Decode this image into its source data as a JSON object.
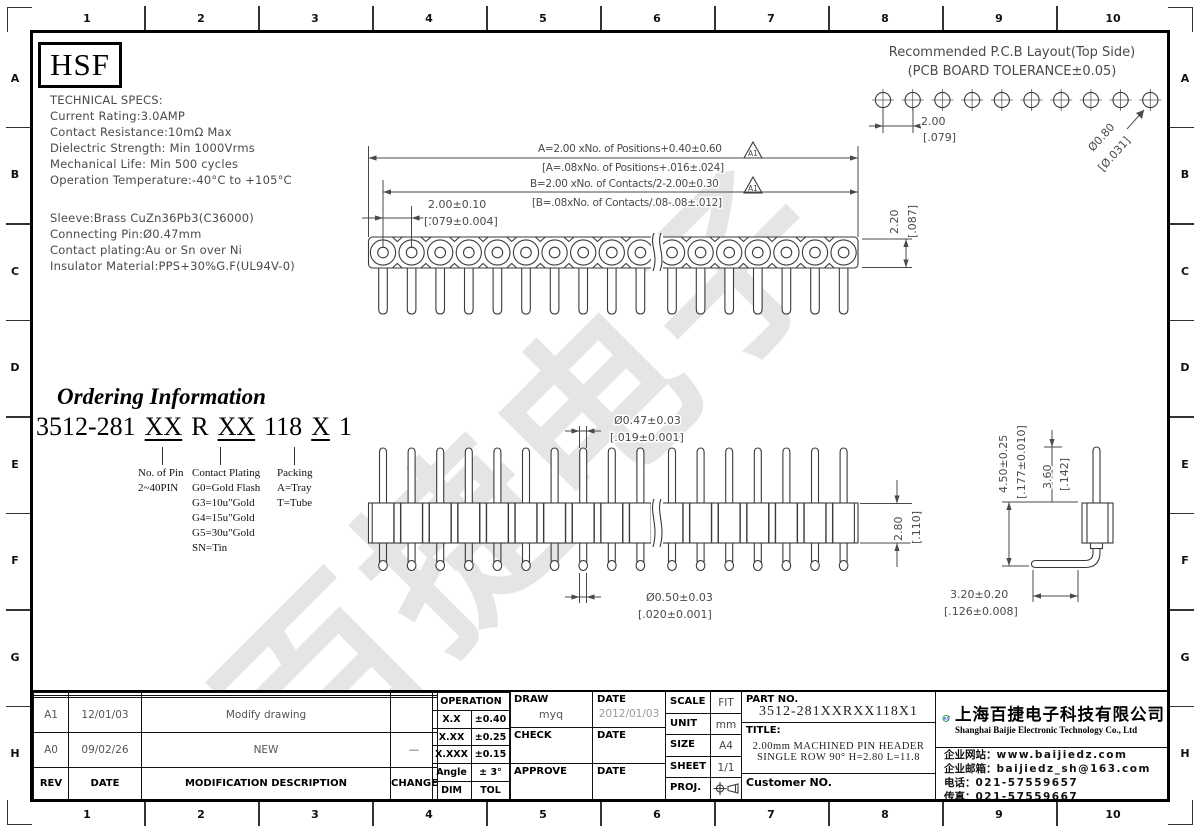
{
  "frame": {
    "columns": [
      "1",
      "2",
      "3",
      "4",
      "5",
      "6",
      "7",
      "8",
      "9",
      "10"
    ],
    "rows": [
      "A",
      "B",
      "C",
      "D",
      "E",
      "F",
      "G",
      "H"
    ]
  },
  "header_logo": "HSF",
  "watermark": "百捷电子",
  "tech_specs": {
    "lines1": [
      "TECHNICAL SPECS:",
      "Current Rating:3.0AMP",
      "Contact Resistance:10mΩ Max",
      "Dielectric Strength: Min 1000Vrms",
      "Mechanical Life: Min 500 cycles",
      "Operation Temperature:-40°C to +105°C"
    ],
    "lines2": [
      "Sleeve:Brass CuZn36Pb3(C36000)",
      "Connecting Pin:Ø0.47mm",
      "Contact plating:Au or Sn over Ni",
      "Insulator Material:PPS+30%G.F(UL94V-0)"
    ]
  },
  "pcb_layout": {
    "title": "Recommended P.C.B Layout(Top Side)",
    "subtitle": "(PCB BOARD TOLERANCE±0.05)",
    "hole_count": 10,
    "pitch_mm": "2.00",
    "pitch_in": "[.079]",
    "hole_dia_mm": "Ø0.80",
    "hole_dia_in": "[Ø.031]"
  },
  "dims": {
    "flag": "A1",
    "a_line1": "A=2.00 xNo. of Positions+0.40±0.60",
    "a_line2": "[A=.08xNo. of Positions+.016±.024]",
    "b_line1": "B=2.00 xNo. of Contacts/2-2.00±0.30",
    "b_line2": "[B=.08xNo. of Contacts/.08-.08±.012]",
    "pitch_mm": "2.00±0.10",
    "pitch_in": "[.079±0.004]",
    "body_h_mm": "2.20",
    "body_h_in": "[.087]",
    "pin_top_mm": "Ø0.47±0.03",
    "pin_top_in": "[.019±0.001]",
    "pin_bot_mm": "Ø0.50±0.03",
    "pin_bot_in": "[.020±0.001]",
    "ins_h_mm": "2.80",
    "ins_h_in": "[.110]",
    "total_mm": "4.50±0.25",
    "total_in": "[.177±0.010]",
    "tail_mm": "3.60",
    "tail_in": "[.142]",
    "leg_mm": "3.20±0.20",
    "leg_in": "[.126±0.008]"
  },
  "ordering": {
    "title": "Ordering Information",
    "code": [
      {
        "t": "3512-281",
        "u": false
      },
      {
        "t": "XX",
        "u": true
      },
      {
        "t": "R",
        "u": false
      },
      {
        "t": "XX",
        "u": true
      },
      {
        "t": "118",
        "u": false
      },
      {
        "t": "X",
        "u": true
      },
      {
        "t": "1",
        "u": false
      }
    ],
    "columns": [
      {
        "lines": [
          "No. of Pin",
          "2~40PIN"
        ]
      },
      {
        "lines": [
          "Contact Plating",
          "G0=Gold Flash",
          "G3=10u\"Gold",
          "G4=15u\"Gold",
          "G5=30u\"Gold",
          "SN=Tin"
        ]
      },
      {
        "lines": [
          "Packing",
          "A=Tray",
          "T=Tube"
        ]
      }
    ]
  },
  "drawing": {
    "top_view": {
      "left_positions": 10,
      "right_positions": 7
    },
    "front_view": {
      "left_positions": 10,
      "right_positions": 7
    }
  },
  "title_block": {
    "revision": {
      "rows": [
        [
          "",
          "",
          "",
          ""
        ],
        [
          "",
          "",
          "",
          ""
        ],
        [
          "A1",
          "12/01/03",
          "Modify drawing",
          ""
        ],
        [
          "A0",
          "09/02/26",
          "NEW",
          "—"
        ]
      ],
      "header": [
        "REV",
        "DATE",
        "MODIFICATION  DESCRIPTION",
        "CHANGE"
      ]
    },
    "tolerance": {
      "header": "OPERATION",
      "rows": [
        [
          "X.X",
          "±0.40"
        ],
        [
          "X.XX",
          "±0.25"
        ],
        [
          "X.XXX",
          "±0.15"
        ],
        [
          "Angle",
          "± 3°"
        ]
      ],
      "footer": [
        "DIM",
        "TOL"
      ]
    },
    "signoff": {
      "draw_label": "DRAW",
      "draw_value": "myq",
      "date_label": "DATE",
      "draw_date": "2012/01/03",
      "check_label": "CHECK",
      "approve_label": "APPROVE"
    },
    "doc_info": {
      "scale_label": "SCALE",
      "scale": "FIT",
      "unit_label": "UNIT",
      "unit": "mm",
      "size_label": "SIZE",
      "size": "A4",
      "sheet_label": "SHEET",
      "sheet": "1/1",
      "proj_label": "PROJ."
    },
    "part": {
      "part_no_label": "PART NO.",
      "part_no": "3512-281XXRXX118X1",
      "title_label": "TITLE:",
      "title_line1": "2.00mm MACHINED PIN HEADER",
      "title_line2": "SINGLE ROW 90° H=2.80 L=11.8",
      "customer_label": "Customer NO."
    },
    "company": {
      "logo_text": "BJ",
      "name_cn": "上海百捷电子科技有限公司",
      "name_en": "Shanghai Baijie Electronic Technology Co., Ltd",
      "contact": [
        {
          "label": "企业网站：",
          "value": "www.baijiedz.com"
        },
        {
          "label": "企业邮箱：",
          "value": "baijiedz_sh@163.com"
        },
        {
          "label": "电话：",
          "value": "021-57559657"
        },
        {
          "label": "传真：",
          "value": "021-57559667"
        }
      ],
      "green": "#1f9d3f",
      "blue": "#1257a8"
    }
  }
}
